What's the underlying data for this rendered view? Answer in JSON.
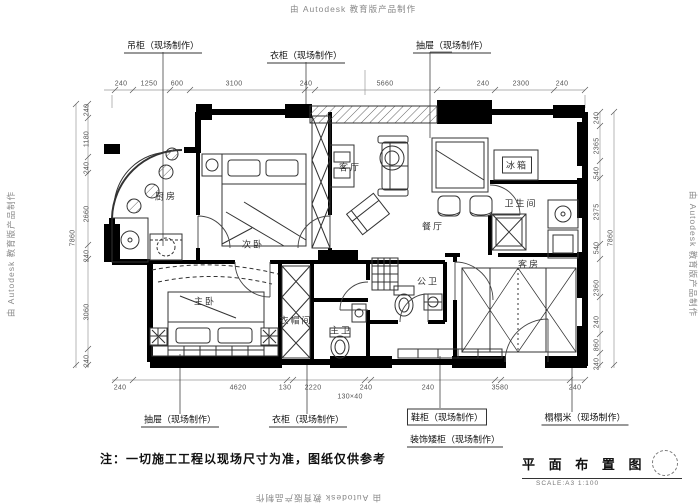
{
  "watermarks": {
    "top": "由 Autodesk 教育版产品制作",
    "bottom": "由 Autodesk 教育版产品制作",
    "left": "由 Autodesk 教育版产品制作",
    "right": "由 Autodesk 教育版产品制作"
  },
  "note": "注：一切施工工程以现场尺寸为准，图纸仅供参考",
  "title_block": {
    "title": "平 面 布 置 图",
    "scale": "SCALE:A3 1:100"
  },
  "annotations": {
    "rooms": [
      {
        "t": "厨房",
        "x": 166,
        "y": 196
      },
      {
        "t": "次卧",
        "x": 253,
        "y": 244
      },
      {
        "t": "客厅",
        "x": 350,
        "y": 167
      },
      {
        "t": "餐厅",
        "x": 433,
        "y": 226
      },
      {
        "t": "冰箱",
        "x": 517,
        "y": 165,
        "box": true
      },
      {
        "t": "卫生间",
        "x": 521,
        "y": 203
      },
      {
        "t": "主卧",
        "x": 205,
        "y": 301
      },
      {
        "t": "衣帽间",
        "x": 296,
        "y": 320
      },
      {
        "t": "主卫",
        "x": 341,
        "y": 330
      },
      {
        "t": "公卫",
        "x": 428,
        "y": 281
      },
      {
        "t": "客房",
        "x": 529,
        "y": 264
      }
    ],
    "callouts_top": [
      {
        "t": "吊柜（现场制作）",
        "x": 163,
        "y": 46
      },
      {
        "t": "衣柜（现场制作）",
        "x": 306,
        "y": 56
      },
      {
        "t": "抽屉（现场制作）",
        "x": 452,
        "y": 46
      }
    ],
    "callouts_bottom": [
      {
        "t": "抽屉（现场制作）",
        "x": 180,
        "y": 420
      },
      {
        "t": "衣柜（现场制作）",
        "x": 308,
        "y": 420
      },
      {
        "t": "鞋柜（现场制作）",
        "x": 447,
        "y": 417,
        "box": true
      },
      {
        "t": "装饰矮柜（现场制作）",
        "x": 455,
        "y": 440
      },
      {
        "t": "榻榻米（现场制作）",
        "x": 585,
        "y": 418
      }
    ],
    "dims_top": [
      {
        "t": "240",
        "x": 121,
        "y": 84
      },
      {
        "t": "1250",
        "x": 149,
        "y": 84
      },
      {
        "t": "600",
        "x": 177,
        "y": 84
      },
      {
        "t": "3100",
        "x": 234,
        "y": 84
      },
      {
        "t": "240",
        "x": 306,
        "y": 84
      },
      {
        "t": "5660",
        "x": 385,
        "y": 84
      },
      {
        "t": "240",
        "x": 483,
        "y": 84
      },
      {
        "t": "2300",
        "x": 521,
        "y": 84
      },
      {
        "t": "240",
        "x": 562,
        "y": 84
      }
    ],
    "dims_bottom": [
      {
        "t": "240",
        "x": 120,
        "y": 388
      },
      {
        "t": "4620",
        "x": 238,
        "y": 388
      },
      {
        "t": "130",
        "x": 285,
        "y": 388
      },
      {
        "t": "2220",
        "x": 313,
        "y": 388
      },
      {
        "t": "240",
        "x": 366,
        "y": 388
      },
      {
        "t": "130×40",
        "x": 350,
        "y": 397
      },
      {
        "t": "240",
        "x": 428,
        "y": 388
      },
      {
        "t": "3580",
        "x": 500,
        "y": 388
      },
      {
        "t": "240",
        "x": 575,
        "y": 388
      }
    ],
    "dims_left": [
      {
        "t": "240",
        "x": 87,
        "y": 110
      },
      {
        "t": "1180",
        "x": 87,
        "y": 139
      },
      {
        "t": "240",
        "x": 87,
        "y": 168
      },
      {
        "t": "2660",
        "x": 87,
        "y": 214
      },
      {
        "t": "240",
        "x": 87,
        "y": 256
      },
      {
        "t": "3060",
        "x": 87,
        "y": 312
      },
      {
        "t": "240",
        "x": 87,
        "y": 361
      },
      {
        "t": "7860",
        "x": 73,
        "y": 238
      }
    ],
    "dims_right": [
      {
        "t": "240",
        "x": 597,
        "y": 118
      },
      {
        "t": "2365",
        "x": 597,
        "y": 146
      },
      {
        "t": "540",
        "x": 597,
        "y": 173
      },
      {
        "t": "2375",
        "x": 597,
        "y": 212
      },
      {
        "t": "540",
        "x": 597,
        "y": 248
      },
      {
        "t": "2360",
        "x": 597,
        "y": 288
      },
      {
        "t": "240",
        "x": 597,
        "y": 322
      },
      {
        "t": "860",
        "x": 597,
        "y": 345
      },
      {
        "t": "240",
        "x": 597,
        "y": 364
      },
      {
        "t": "7860",
        "x": 611,
        "y": 238
      }
    ]
  }
}
